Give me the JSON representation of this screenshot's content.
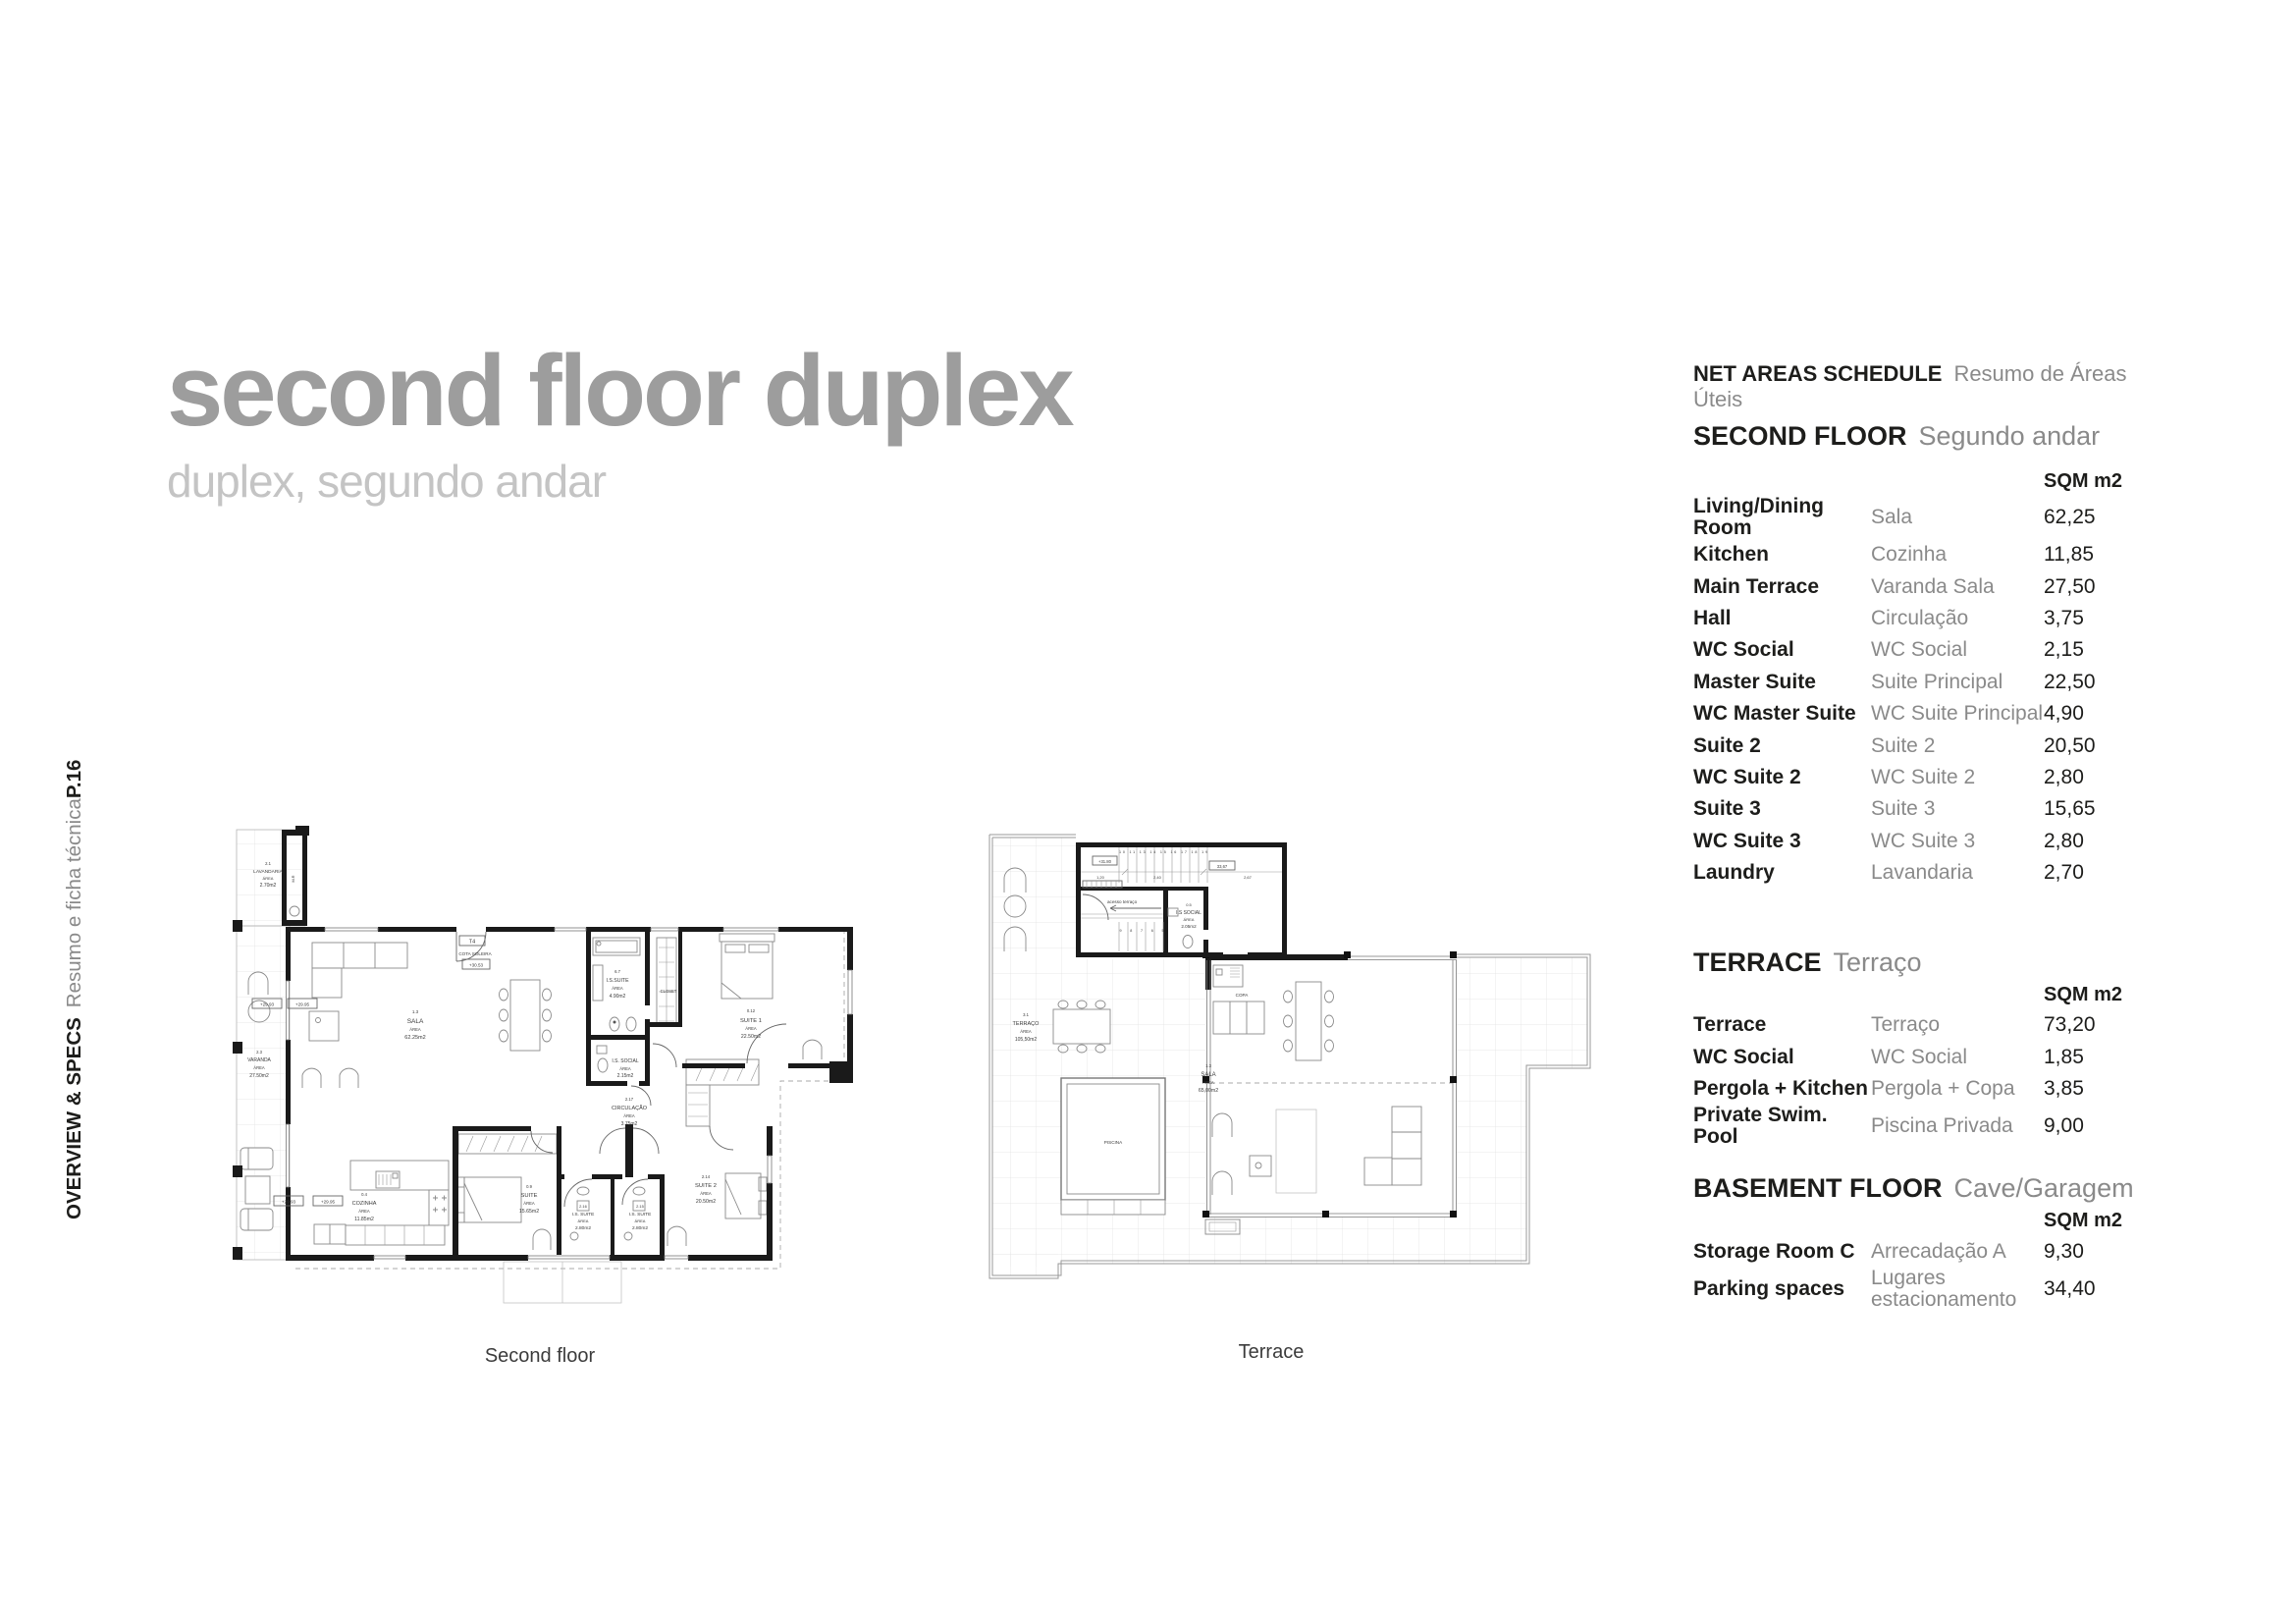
{
  "page": {
    "title": "second floor duplex",
    "subtitle": "duplex, segundo andar"
  },
  "sidebar": {
    "section": "OVERVIEW & SPECS",
    "section_pt": "Resumo e ficha técnica",
    "page_number": "P.16"
  },
  "captions": {
    "left": "Second floor",
    "right": "Terrace"
  },
  "schedule": {
    "title": "NET AREAS SCHEDULE",
    "title_pt": "Resumo de Áreas Úteis",
    "unit_header": "SQM m2",
    "sections": [
      {
        "name": "SECOND FLOOR",
        "name_pt": "Segundo andar",
        "rows": [
          [
            "Living/Dining Room",
            "Sala",
            "62,25"
          ],
          [
            "Kitchen",
            "Cozinha",
            "11,85"
          ],
          [
            "Main Terrace",
            "Varanda Sala",
            "27,50"
          ],
          [
            "Hall",
            "Circulação",
            "3,75"
          ],
          [
            "WC Social",
            "WC Social",
            "2,15"
          ],
          [
            "Master Suite",
            "Suite Principal",
            "22,50"
          ],
          [
            "WC Master Suite",
            "WC Suite Principal",
            "4,90"
          ],
          [
            "Suite 2",
            "Suite 2",
            "20,50"
          ],
          [
            "WC Suite 2",
            "WC Suite 2",
            "2,80"
          ],
          [
            "Suite 3",
            "Suite 3",
            "15,65"
          ],
          [
            "WC Suite 3",
            "WC Suite 3",
            "2,80"
          ],
          [
            "Laundry",
            "Lavandaria",
            "2,70"
          ]
        ]
      },
      {
        "name": "TERRACE",
        "name_pt": "Terraço",
        "rows": [
          [
            "Terrace",
            "Terraço",
            "73,20"
          ],
          [
            "WC Social",
            "WC Social",
            "1,85"
          ],
          [
            "Pergola + Kitchen",
            "Pergola + Copa",
            "3,85"
          ],
          [
            "Private Swim. Pool",
            "Piscina Privada",
            "9,00"
          ]
        ]
      },
      {
        "name": "BASEMENT FLOOR",
        "name_pt": "Cave/Garagem",
        "rows": [
          [
            "Storage Room C",
            "Arrecadação A",
            "9,30"
          ],
          [
            "Parking spaces",
            "Lugares estacionamento",
            "34,40"
          ]
        ]
      }
    ]
  },
  "plans_common": {
    "area_word": "ÁREA"
  },
  "plan_second": {
    "rooms": {
      "lavandaria": {
        "num": "2.1",
        "name": "LAVANDARIA",
        "area": "2.70m2"
      },
      "mr": {
        "name": "M.R"
      },
      "sala": {
        "num": "1.3",
        "name": "SALA",
        "area": "62.25m2"
      },
      "is_suite_master": {
        "num": "6.7",
        "name": "I.S.SUITE",
        "area": "4.90m2"
      },
      "closet": {
        "name": "CLOSET"
      },
      "suite1": {
        "num": "0.12",
        "name": "SUITE 1",
        "area": "22.50m2"
      },
      "is_social": {
        "name": "I.S. SOCIAL",
        "area": "2.15m2"
      },
      "circulacao": {
        "num": "2.17",
        "name": "CIRCULAÇÃO",
        "area": "3.75m2"
      },
      "varanda": {
        "num": "2.3",
        "name": "VARANDA",
        "area": "27.50m2"
      },
      "cozinha": {
        "num": "0.4",
        "name": "COZINHA",
        "area": "11.85m2"
      },
      "suite3": {
        "num": "0.9",
        "name": "SUITE",
        "area": "15.65m2"
      },
      "is_suite2": {
        "num": "2.16",
        "name": "I.S. SUITE",
        "area": "2.80m2"
      },
      "is_suite3": {
        "num": "2.15",
        "name": "I.S. SUITE",
        "area": "2.80m2"
      },
      "suite2": {
        "num": "2.14",
        "name": "SUITE 2",
        "area": "20.50m2"
      }
    },
    "markers": {
      "t4": "T4",
      "cota": "COTA SOLEIRA",
      "cota_level": "+30.53",
      "level_a": "+29.93",
      "level_b": "+29.95"
    }
  },
  "plan_terrace": {
    "rooms": {
      "terraco": {
        "num": "3.1",
        "name": "TERRAÇO",
        "area": "105,50m2"
      },
      "sala": {
        "num": "1.3",
        "name": "SALA",
        "area": "65,00m2"
      },
      "social": {
        "num": "0.5",
        "name": "I.S SOCIAL",
        "area": "2.05m2"
      },
      "copa": {
        "name": "COPA"
      },
      "piscina": {
        "name": "PISCINA"
      }
    },
    "markers": {
      "acesso": "acesso terraço",
      "level": "+31.80",
      "dim_total": "33,67",
      "dim1": "1,20",
      "dim2": "2,40",
      "dim3": "2,67",
      "stairs_up": "10 11 13 14 15 16 17 18 19",
      "stairs_down": "9 8 7 6 5"
    }
  }
}
